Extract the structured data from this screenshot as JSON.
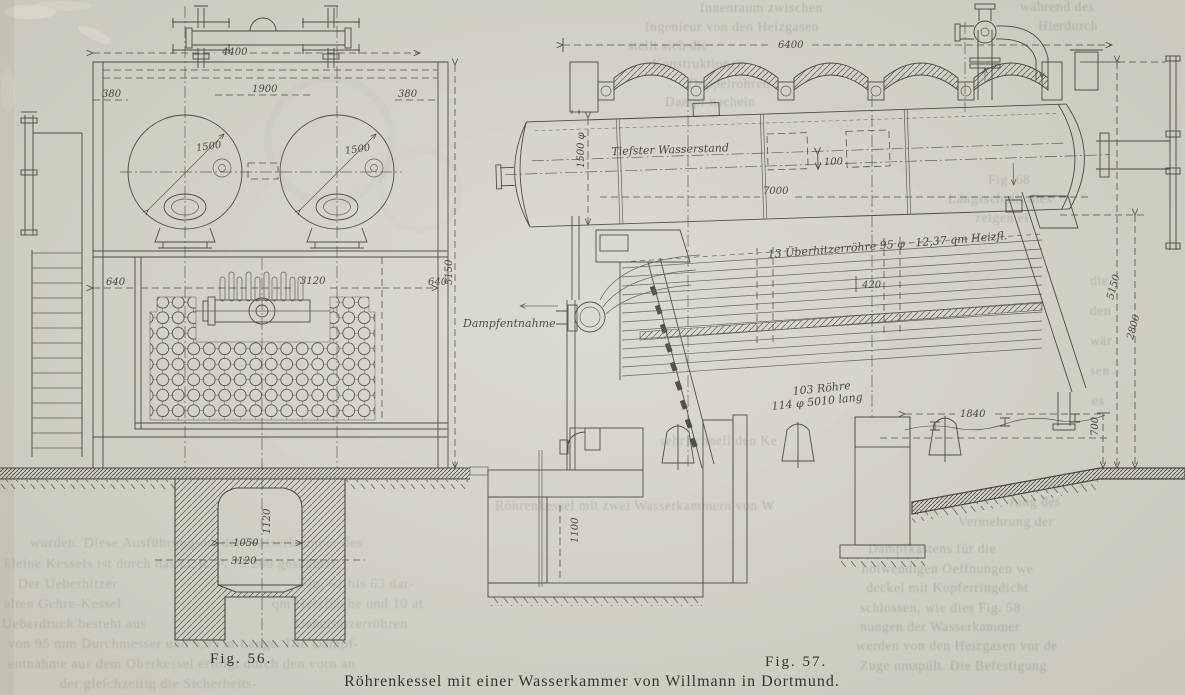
{
  "page": {
    "caption": "Röhrenkessel mit einer Wasserkammer von Willmann in Dortmund."
  },
  "fig56": {
    "label": "Fig. 56.",
    "dims": {
      "top_width": "4400",
      "left_offset": "380",
      "drum_spacing": "1900",
      "right_offset": "380",
      "drum_dia_left": "1500",
      "drum_dia_right": "1500",
      "lower_left": "640",
      "lower_width": "3120",
      "lower_right": "640",
      "height": "5150",
      "pit_height": "1120",
      "pit_width_inner": "1050",
      "pit_width_outer": "3120"
    }
  },
  "fig57": {
    "label": "Fig. 57.",
    "dims": {
      "top_width": "6400",
      "drum_dia": "1500 φ",
      "water_gap": "100",
      "drum_length": "7000",
      "tube_dim": "420",
      "support_span": "1840",
      "height_total": "5150",
      "height_mid": "2800",
      "height_base": "700",
      "pit_depth": "1100"
    },
    "annotations": {
      "water_level": "Tiefster Wasserstand",
      "superheater": "13 Überhitzerröhre 95 φ · 12,37 qm Heizfl.",
      "steam_outlet": "Dampfentnahme",
      "tubes_line1": "103 Röhre",
      "tubes_line2": "114 φ 5010 lang"
    }
  },
  "bleed": {
    "lines": [
      "Innenraum zwischen",
      "während des",
      "Ingenieur von den Heizgasen",
      "Hierdurch",
      "stellt sich die",
      "Konstruktionen",
      "Doppelrohren",
      "Dampf nachein",
      "Fig. 68",
      "Längsschnitt dies",
      "zeigen ei",
      "die",
      "den",
      "wär",
      "sen",
      "es",
      "sehr schnell den Ke",
      "Röhrenkessel mit zwei Wasserkammern von W",
      "wurden. Diese Ausführungsart der Wasserkammer des",
      "kleine Kessels ist durch das D. R. P. 73 280 geschützt.",
      "Der Ueberhitzer",
      "Fig. 61 bis 63 dar-",
      "alten Gehre-Kessel",
      "qm Heizfläche und 10 at",
      "Ueberdruck besteht aus",
      "Ueberhitzerröhren",
      "von 95 mm Durchmesser und 5,85 m Länge. Die Dampf-",
      "entnahme aus dem Oberkessel erfolgt durch den vorn an",
      "der gleichzeitig die Sicherheits-",
      "rung des",
      "Vermehrung der",
      "Dampfkastens für die",
      "notwendigen Oeffnungen we",
      "deckel mit Kupferringdicht",
      "schlossen, wie dies Fig. 58",
      "nungen der Wasserkammer",
      "werden von den Heizgasen vor de",
      "Zuge umspült. Die Befestigung"
    ]
  }
}
